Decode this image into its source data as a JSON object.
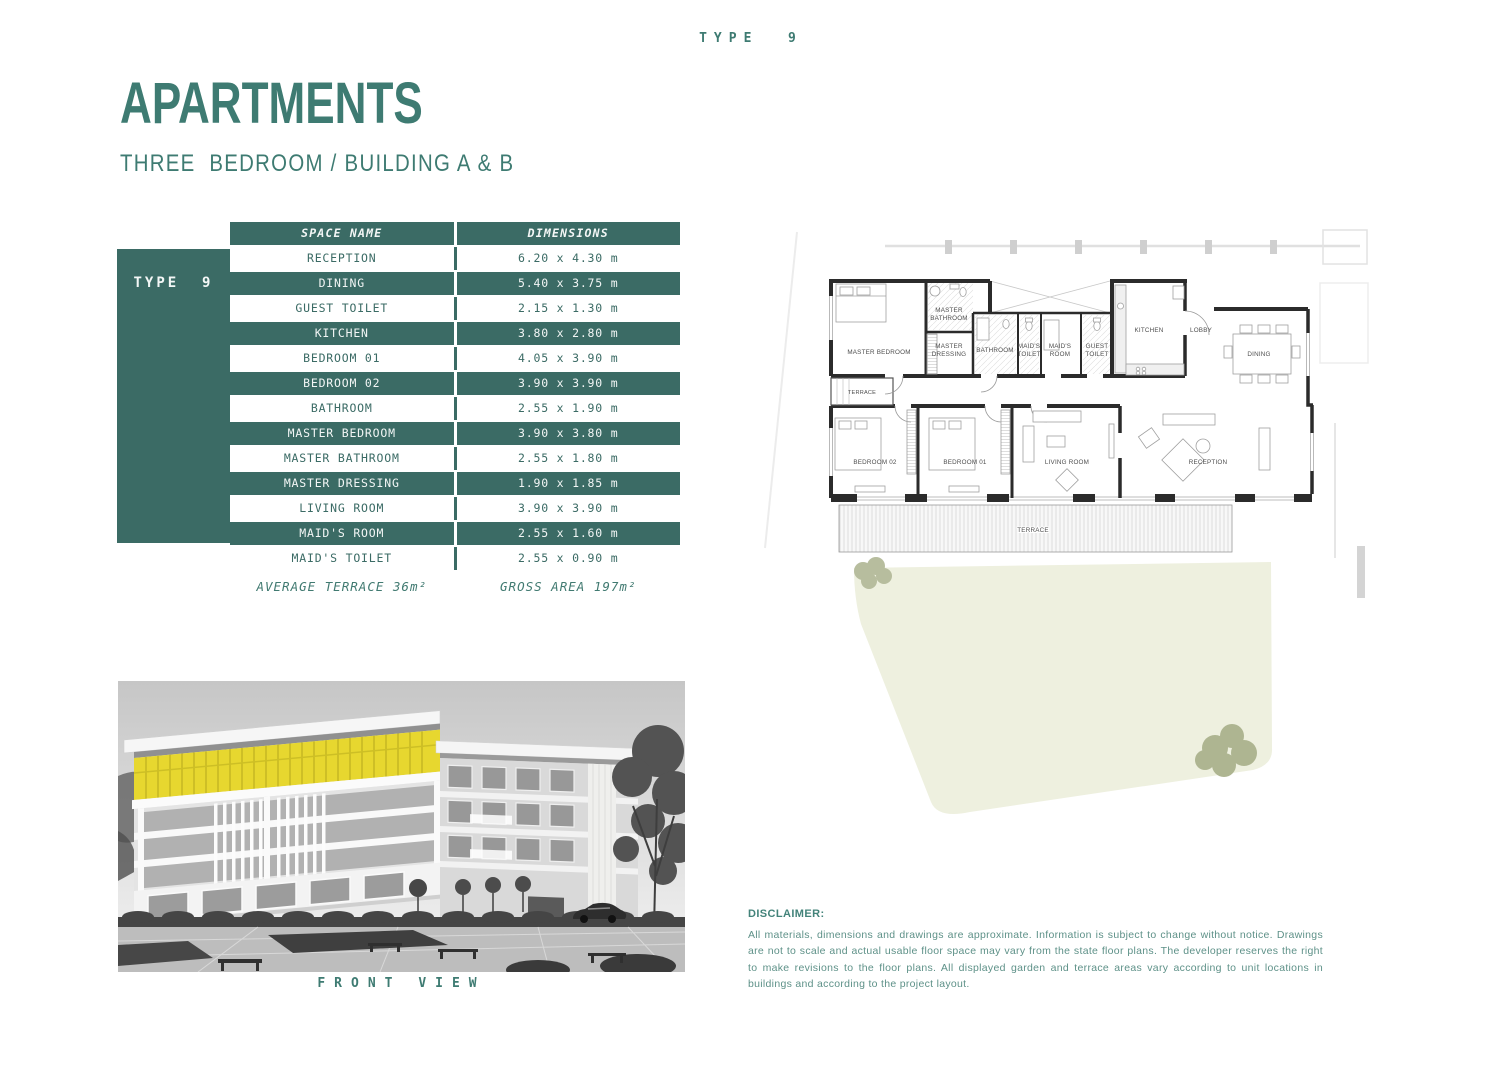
{
  "page": {
    "type_label": "TYPE  9"
  },
  "colors": {
    "teal": "#3B6B65",
    "title_teal": "#3E7B72",
    "highlight_yellow": "#E7D72F",
    "garden_beige": "#EEF0DF"
  },
  "header": {
    "title": "APARTMENTS",
    "subtitle": "THREE  BEDROOM / BUILDING A & B"
  },
  "table": {
    "side_label": "TYPE  9",
    "columns": [
      "SPACE NAME",
      "DIMENSIONS"
    ],
    "rows": [
      {
        "name": "RECEPTION",
        "dims": "6.20 x 4.30 m"
      },
      {
        "name": "DINING",
        "dims": "5.40 x 3.75 m"
      },
      {
        "name": "GUEST TOILET",
        "dims": "2.15 x 1.30 m"
      },
      {
        "name": "KITCHEN",
        "dims": "3.80 x 2.80 m"
      },
      {
        "name": "BEDROOM 01",
        "dims": "4.05 x 3.90 m"
      },
      {
        "name": "BEDROOM 02",
        "dims": "3.90 x 3.90 m"
      },
      {
        "name": "BATHROOM",
        "dims": "2.55 x 1.90 m"
      },
      {
        "name": "MASTER BEDROOM",
        "dims": "3.90 x 3.80 m"
      },
      {
        "name": "MASTER BATHROOM",
        "dims": "2.55 x 1.80 m"
      },
      {
        "name": "MASTER DRESSING",
        "dims": "1.90 x 1.85 m"
      },
      {
        "name": "LIVING ROOM",
        "dims": "3.90 x 3.90 m"
      },
      {
        "name": "MAID'S ROOM",
        "dims": "2.55 x 1.60 m"
      },
      {
        "name": "MAID'S TOILET",
        "dims": "2.55 x 0.90 m"
      }
    ],
    "footer": {
      "left": "AVERAGE TERRACE 36m²",
      "right": "GROSS AREA 197m²"
    }
  },
  "photo": {
    "caption": "FRONT VIEW"
  },
  "floorplan": {
    "labels": [
      {
        "t": "MASTER BEDROOM"
      },
      {
        "t": "MASTER"
      },
      {
        "t": "BATHROOM"
      },
      {
        "t": "MASTER"
      },
      {
        "t": "DRESSING"
      },
      {
        "t": "BATHROOM"
      },
      {
        "t": "MAID'S"
      },
      {
        "t": "TOILET"
      },
      {
        "t": "MAID'S"
      },
      {
        "t": "ROOM"
      },
      {
        "t": "GUEST"
      },
      {
        "t": "TOILET"
      },
      {
        "t": "KITCHEN"
      },
      {
        "t": "LOBBY"
      },
      {
        "t": "DINING"
      },
      {
        "t": "TERRACE"
      },
      {
        "t": "BEDROOM 02"
      },
      {
        "t": "BEDROOM 01"
      },
      {
        "t": "LIVING ROOM"
      },
      {
        "t": "RECEPTION"
      },
      {
        "t": "TERRACE"
      }
    ]
  },
  "disclaimer": {
    "heading": "DISCLAIMER:",
    "body": "All materials, dimensions and drawings are approximate. Information is subject to change without notice. Drawings are not to scale and actual usable floor space may vary from the state floor plans. The developer reserves the right to make revisions to the floor plans. All displayed garden and terrace areas vary according to unit locations in buildings and according to the project layout."
  }
}
